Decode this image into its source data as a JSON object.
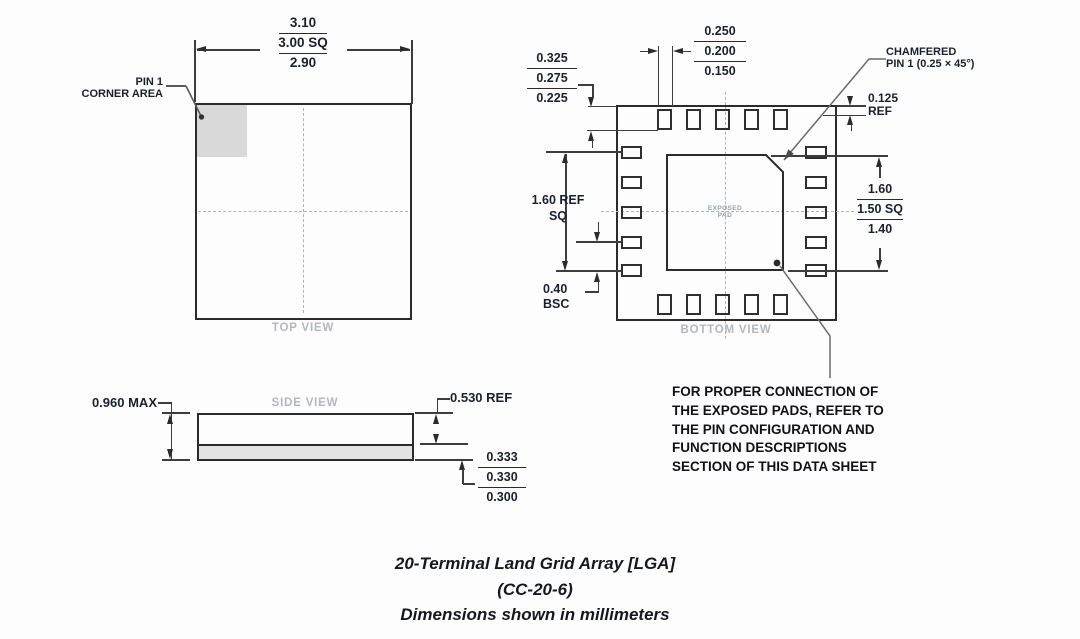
{
  "drawing": {
    "top_view": {
      "label": "TOP VIEW",
      "pin1_callout": [
        "PIN 1",
        "CORNER AREA"
      ],
      "body_size_dim": [
        "3.10",
        "3.00 SQ",
        "2.90"
      ]
    },
    "bottom_view": {
      "label": "BOTTOM VIEW",
      "exposed_pad_label": [
        "EXPOSED",
        "PAD"
      ],
      "terminal_length_dim": [
        "0.325",
        "0.275",
        "0.225"
      ],
      "terminal_width_dim": [
        "0.250",
        "0.200",
        "0.150"
      ],
      "chamfer_callout": [
        "CHAMFERED",
        "PIN 1 (0.25 × 45°)"
      ],
      "chamfer_ref_dim": [
        "0.125",
        "REF"
      ],
      "terminal_span_dim": [
        "1.60 REF",
        "SQ"
      ],
      "pitch_dim": [
        "0.40",
        "BSC"
      ],
      "exposed_pad_size_dim": [
        "1.60",
        "1.50 SQ",
        "1.40"
      ]
    },
    "side_view": {
      "label": "SIDE VIEW",
      "overall_height_dim": "0.960 MAX",
      "body_height_dim": "0.530 REF",
      "terminal_height_dim": [
        "0.333",
        "0.330",
        "0.300"
      ]
    },
    "note_lines": [
      "FOR PROPER CONNECTION OF",
      "THE EXPOSED PADS, REFER TO",
      "THE PIN CONFIGURATION AND",
      "FUNCTION DESCRIPTIONS",
      "SECTION OF THIS DATA SHEET"
    ],
    "caption": [
      "20-Terminal Land Grid Array [LGA]",
      "(CC-20-6)",
      "Dimensions shown in millimeters"
    ],
    "colors": {
      "line": "#2b2b2b",
      "dimension_text": "#1a2030",
      "view_label": "#b3b8bc",
      "pin1_shade": "#d9d9d9",
      "terminal_strip": "#e3e3e3"
    }
  }
}
